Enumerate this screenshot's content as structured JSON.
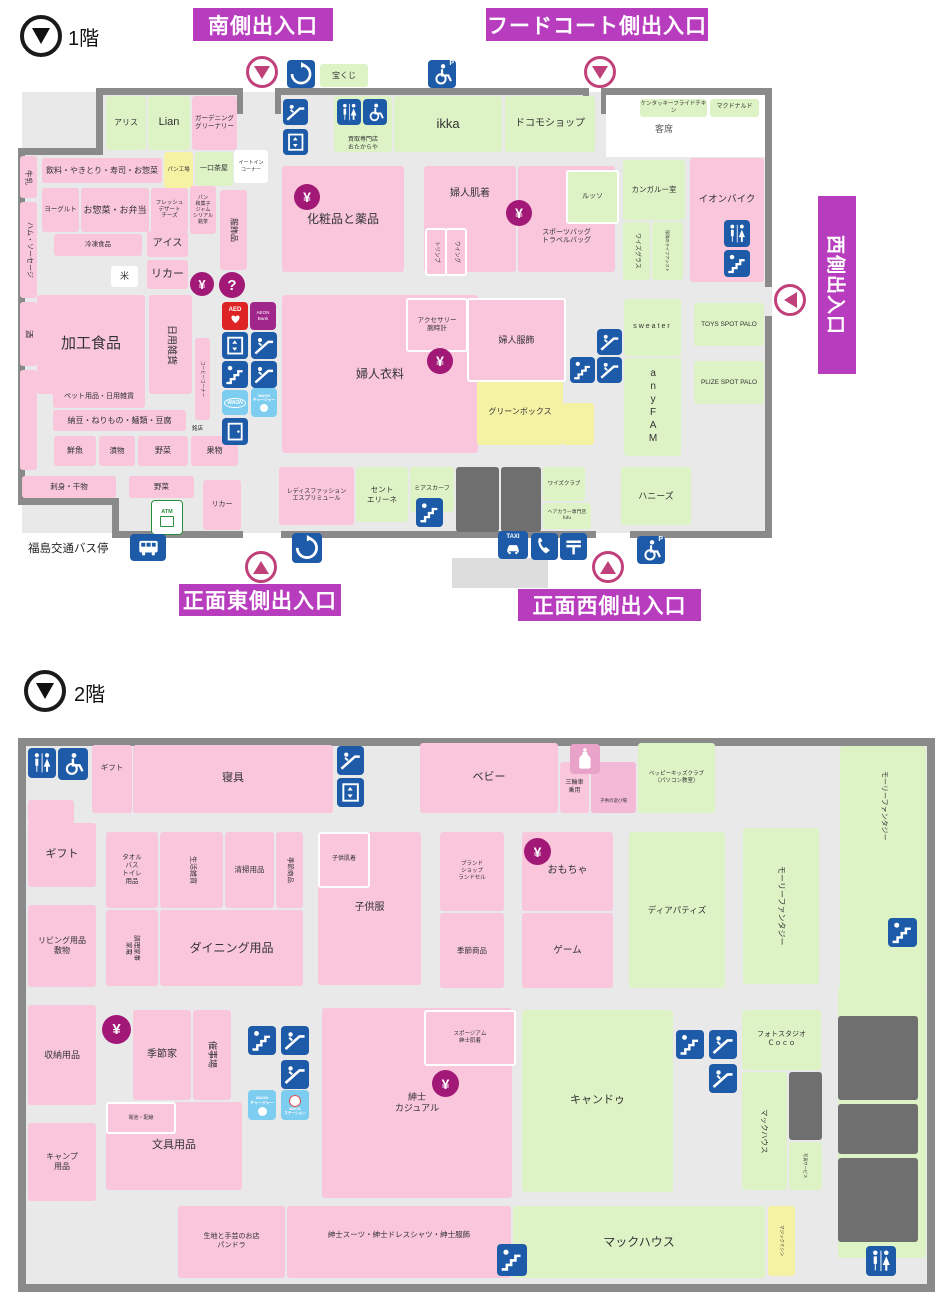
{
  "f1": {
    "floor": "1階",
    "banners": {
      "south": "南側出入口",
      "foodcourt": "フードコート側出入口",
      "west": "西側出入口",
      "front_east": "正面東側出入口",
      "front_west": "正面西側出入口"
    },
    "busstop": "福島交通バス停",
    "shops": {
      "arisu": "アリス",
      "lian": "Lian",
      "gardening": "ガーデニング\nグリーナリー",
      "takuji": "宝くじ",
      "kaitori": "買取専門店\nおたからや",
      "ikka": "ikka",
      "docomo": "ドコモショップ",
      "kfc": "ケンタッキーフライドチキン",
      "mcd": "マクドナルド",
      "seats": "客席",
      "gyunyu": "牛乳",
      "inryo": "飲料・やきとり・寿司・お惣菜",
      "pan_kojo": "パン工場",
      "hitokuchi": "一口茶屋",
      "eatin": "イートイン\nコーナー",
      "yogurt": "ヨーグルト",
      "osozai": "お惣菜・お弁当",
      "fresh": "フレッシュ\nデザート\nチーズ",
      "pan_wagashi": "パン\n和菓子\nジャム\nシリアル\n銘茶",
      "fukushokuhin": "服飾品",
      "ham": "ハム・ソーセージ",
      "reito": "冷凍食品",
      "ice": "アイス",
      "kome": "米",
      "liquor": "リカー",
      "kako": "加工食品",
      "nichiyo": "日用雑貨",
      "sake": "酒",
      "coffee": "コーヒーコーナー",
      "meiten": "銘店",
      "pet": "ペット用品・日用雑貨",
      "natto": "納豆・ねりもの・麺類・豆腐",
      "sengyo": "鮮魚",
      "tsukemono": "漬物",
      "yasai": "野菜",
      "kudamono": "果物",
      "sashimi": "刺身・干物",
      "yasai2": "野菜",
      "liquor2": "リカー",
      "keshohin": "化粧品と薬品",
      "fujin_hadagi": "婦人肌着",
      "triumph": "トリンプ",
      "wing": "ウイング",
      "russo": "ルッソ",
      "sports_bag": "スポーツバッグ\nトラベルバッグ",
      "kangaroo": "カンガルー室",
      "ysglass": "ワイズグラス",
      "hoken": "保険のライフアシスト",
      "aeon_bike": "イオンバイク",
      "fujin_iryo": "婦人衣料",
      "accessory": "アクセサリー\n腕時計",
      "fujin_fukushoku": "婦人服飾",
      "greenbox": "グリーンボックス",
      "sweater": "sweater",
      "anyfam": "anyFAM",
      "toys_spot": "TOYS SPOT PALO",
      "plize_spot": "PLIZE SPOT PALO",
      "esprit": "レディスファッション\nエスプリミュール",
      "saint": "セント\nエリーネ",
      "mia": "ミアスカーフ",
      "ysclub": "ワイズクラブ",
      "fufu": "ヘアカラー専門店\nfufu",
      "honeys": "ハニーズ"
    }
  },
  "f2": {
    "floor": "2階",
    "shops": {
      "gift_s": "ギフト",
      "shingu": "寝具",
      "baby": "ベビー",
      "sanrinsha": "三輪車\n乗用",
      "asobiba": "子供の遊び場",
      "beppy": "ベッピーキッズクラブ\n（パソコン教室）",
      "molly1": "モーリーファンタジー",
      "molly2": "モーリーファンタジー",
      "gift": "ギフト",
      "living": "リビング用品\n敷物",
      "shuno": "収納用品",
      "camp": "キャンプ\n用品",
      "towel": "タオル\nバス\nトイレ\n用品",
      "seikatsu": "生活雑貨",
      "seiso": "清掃用品",
      "kisetsu_shohin": "季節商品",
      "chori": "調理家事\n家電",
      "dining": "ダイニング用品",
      "kodomo_hadagi": "子供肌着",
      "kodomofuku": "子供服",
      "brand": "ブランド\nショップ\nランドセル",
      "omocha": "おもちゃ",
      "kisetsu2": "季節商品",
      "game": "ゲーム",
      "dear": "ディアパティズ",
      "kisetsuya": "季節家",
      "saijijo": "催事場",
      "denchi": "電池・配線",
      "bungu": "文具用品",
      "shinshi_casual": "紳士\nカジュアル",
      "spogym": "スポージアム\n紳士肌着",
      "cando": "キャンドゥ",
      "photo": "フォトスタジオ\nＣｏｃｏ",
      "mac_side": "マックハウス",
      "photo_service": "写真サービス",
      "thirtyone": "サーティーワン\nアイスクリーム",
      "pandora": "生地と手芸のお店\nパンドラ",
      "shinshi_suit": "紳士スーツ・紳士ドレスシャツ・紳士服飾",
      "machouse": "マックハウス",
      "magic": "マジックミシン"
    }
  },
  "icons": {
    "aed": "AED",
    "aeon_bank": "AEON\nBank",
    "atm": "ATM",
    "taxi": "TAXI",
    "waon": "WAON",
    "waon_charger": "WAON\nチャージャー",
    "waon_station": "WAON\nステーション",
    "yen": "¥",
    "question": "?",
    "wc_p": "P"
  }
}
